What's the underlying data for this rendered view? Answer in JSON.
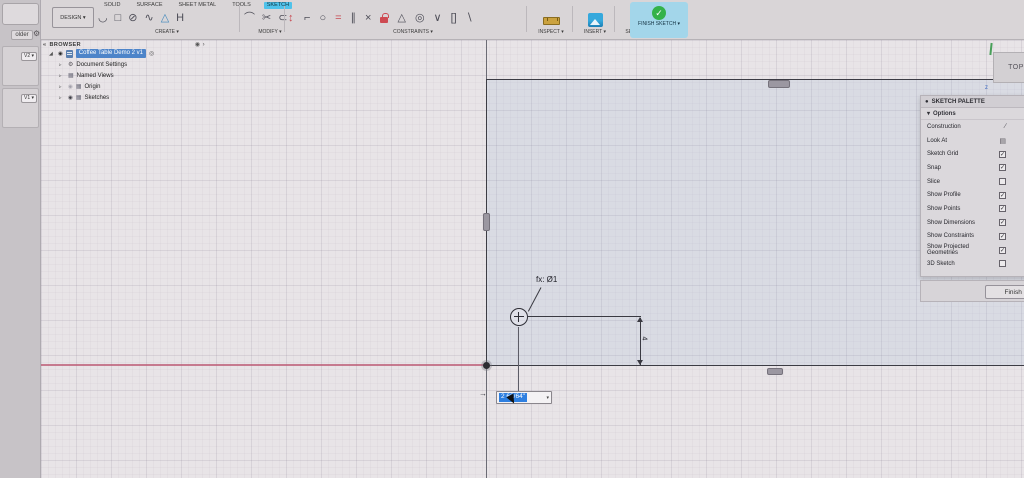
{
  "data_panel": {
    "folder_label": "older",
    "gear_icon": "⚙",
    "version_badges": [
      "V2 ▾",
      "V1 ▾"
    ]
  },
  "toolbar": {
    "design_label": "DESIGN ▾",
    "tabs": [
      {
        "label": "SOLID",
        "active": false
      },
      {
        "label": "SURFACE",
        "active": false
      },
      {
        "label": "SHEET METAL",
        "active": false
      },
      {
        "label": "TOOLS",
        "active": false
      },
      {
        "label": "SKETCH",
        "active": true
      }
    ],
    "create_label": "CREATE ▾",
    "modify_label": "MODIFY ▾",
    "constraints_label": "CONSTRAINTS ▾",
    "inspect_label": "INSPECT ▾",
    "insert_label": "INSERT ▾",
    "select_label": "SELECT ▾",
    "finish_sketch_label": "FINISH SKETCH ▾",
    "finish_check_glyph": "✓",
    "create_icons": [
      {
        "name": "line-icon",
        "glyph": "◡"
      },
      {
        "name": "rectangle-icon",
        "glyph": "□"
      },
      {
        "name": "circle-icon",
        "glyph": "⊘"
      },
      {
        "name": "spline-icon",
        "glyph": "∿"
      },
      {
        "name": "polygon-icon",
        "glyph": "△",
        "color": "blue"
      },
      {
        "name": "slot-icon",
        "glyph": "H"
      }
    ],
    "modify_icons": [
      {
        "name": "fillet-icon",
        "glyph": "⌒"
      },
      {
        "name": "trim-icon",
        "glyph": "✂"
      },
      {
        "name": "offset-icon",
        "glyph": "⊂"
      }
    ],
    "dimension_icon": {
      "name": "sketch-dimension-icon",
      "glyph": "↕"
    },
    "constraint_icons": [
      {
        "name": "horizontal-vertical-icon",
        "glyph": "⌐"
      },
      {
        "name": "tangent-icon",
        "glyph": "○"
      },
      {
        "name": "equal-icon",
        "glyph": "=",
        "color": "red"
      },
      {
        "name": "parallel-icon",
        "glyph": "∥"
      },
      {
        "name": "perpendicular-icon",
        "glyph": "×"
      },
      {
        "name": "fix-icon",
        "glyph": "lock"
      },
      {
        "name": "collinear-icon",
        "glyph": "△"
      },
      {
        "name": "concentric-icon",
        "glyph": "◎"
      },
      {
        "name": "midpoint-icon",
        "glyph": "∨"
      },
      {
        "name": "symmetry-icon",
        "glyph": "[]"
      },
      {
        "name": "smooth-icon",
        "glyph": "∖"
      }
    ]
  },
  "browser": {
    "collapse_icon": "«",
    "header": "BROWSER",
    "header_right_icon": "◉ ›",
    "root": {
      "expand_icon": "◢",
      "eye_icon": "◉",
      "label": "Coffee Table Demo 2 v1",
      "right_icon": "◎"
    },
    "items": [
      {
        "arrow": "▹",
        "icon_name": "gear-icon",
        "glyph": "⚙",
        "eye": "",
        "label": "Document Settings"
      },
      {
        "arrow": "▹",
        "icon_name": "named-views-icon",
        "glyph": "▦",
        "eye": "",
        "label": "Named Views"
      },
      {
        "arrow": "▹",
        "icon_name": "origin-icon",
        "glyph": "▦",
        "eye": "dim",
        "label": "Origin"
      },
      {
        "arrow": "▹",
        "icon_name": "sketches-icon",
        "glyph": "▦",
        "eye": "on",
        "label": "Sketches"
      }
    ]
  },
  "palette": {
    "title": "SKETCH PALETTE",
    "title_icon": "●",
    "options_label": "Options",
    "options_caret": "▾",
    "rows": [
      {
        "label": "Construction",
        "control": "icon",
        "icon_name": "construction-line-icon",
        "glyph": "∕"
      },
      {
        "label": "Look At",
        "control": "icon",
        "icon_name": "look-at-icon",
        "glyph": "▤"
      },
      {
        "label": "Sketch Grid",
        "control": "checkbox",
        "checked": true
      },
      {
        "label": "Snap",
        "control": "checkbox",
        "checked": true
      },
      {
        "label": "Slice",
        "control": "checkbox",
        "checked": false
      },
      {
        "label": "Show Profile",
        "control": "checkbox",
        "checked": true
      },
      {
        "label": "Show Points",
        "control": "checkbox",
        "checked": true
      },
      {
        "label": "Show Dimensions",
        "control": "checkbox",
        "checked": true
      },
      {
        "label": "Show Constraints",
        "control": "checkbox",
        "checked": true
      },
      {
        "label": "Show Projected Geometries",
        "control": "checkbox",
        "checked": true
      },
      {
        "label": "3D Sketch",
        "control": "checkbox",
        "checked": false
      }
    ],
    "check_glyph": "✓",
    "footer_button": "Finish Sketch"
  },
  "canvas": {
    "viewcube_label": "TOP",
    "fx_label": "fx: Ø1",
    "vertical_dim_value": "4",
    "dim_input_value": "2 63/64\"",
    "dim_input_caret": "▾",
    "dim_input_arrow": "→",
    "blue_axis_glyph": "z"
  },
  "colors": {
    "active_tab": "#4fc2ea",
    "finish_chip": "#a3d6ea",
    "finish_check_green": "#34b24a",
    "selection_blue": "#2e7fe0",
    "browser_highlight": "#4d84c9",
    "x_axis_red": "#bd5f79",
    "lock_red": "#ce4a52",
    "sketch_line": "#3c3c44"
  }
}
